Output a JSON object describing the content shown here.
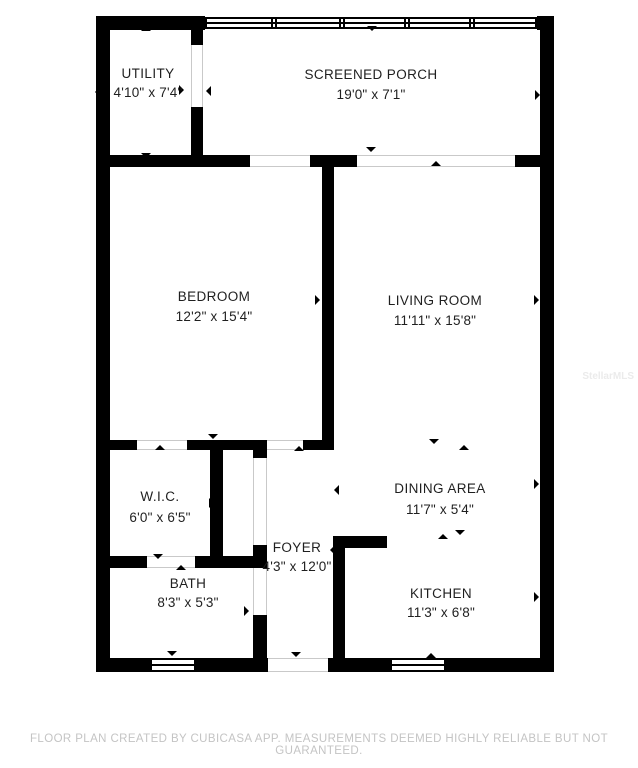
{
  "page": {
    "background": "#ffffff",
    "wall_color": "#000000",
    "opening_line_color": "#c9c9c9"
  },
  "watermark": {
    "text": "StellarMLS",
    "color": "#ebebeb"
  },
  "footer": {
    "text": "FLOOR PLAN CREATED BY CUBICASA APP. MEASUREMENTS DEEMED HIGHLY RELIABLE BUT NOT GUARANTEED.",
    "color": "#c4c4c4"
  },
  "floorplan": {
    "rooms": [
      {
        "id": "utility",
        "name": "UTILITY",
        "dims": "4'10\" x 7'4\"",
        "cx": 148,
        "name_y": 67,
        "dims_y": 86
      },
      {
        "id": "porch",
        "name": "SCREENED PORCH",
        "dims": "19'0\" x 7'1\"",
        "cx": 371,
        "name_y": 68,
        "dims_y": 88
      },
      {
        "id": "bedroom",
        "name": "BEDROOM",
        "dims": "12'2\" x 15'4\"",
        "cx": 214,
        "name_y": 290,
        "dims_y": 310
      },
      {
        "id": "living",
        "name": "LIVING ROOM",
        "dims": "11'11\" x 15'8\"",
        "cx": 435,
        "name_y": 294,
        "dims_y": 314
      },
      {
        "id": "wic",
        "name": "W.I.C.",
        "dims": "6'0\" x 6'5\"",
        "cx": 160,
        "name_y": 490,
        "dims_y": 511
      },
      {
        "id": "dining",
        "name": "DINING AREA",
        "dims": "11'7\" x 5'4\"",
        "cx": 440,
        "name_y": 482,
        "dims_y": 503
      },
      {
        "id": "foyer",
        "name": "FOYER",
        "dims": "4'3\" x 12'0\"",
        "cx": 297,
        "name_y": 541,
        "dims_y": 560
      },
      {
        "id": "bath",
        "name": "BATH",
        "dims": "8'3\" x 5'3\"",
        "cx": 188,
        "name_y": 577,
        "dims_y": 596
      },
      {
        "id": "kitchen",
        "name": "KITCHEN",
        "dims": "11'3\" x 6'8\"",
        "cx": 441,
        "name_y": 587,
        "dims_y": 606
      }
    ],
    "walls": [
      [
        96,
        16,
        14,
        656
      ],
      [
        96,
        16,
        109,
        14
      ],
      [
        537,
        16,
        17,
        14
      ],
      [
        540,
        16,
        14,
        656
      ],
      [
        96,
        658,
        54,
        14
      ],
      [
        196,
        658,
        72,
        14
      ],
      [
        328,
        658,
        62,
        14
      ],
      [
        446,
        658,
        108,
        14
      ],
      [
        191,
        16,
        12,
        29
      ],
      [
        191,
        107,
        12,
        60
      ],
      [
        96,
        155,
        154,
        12
      ],
      [
        310,
        155,
        47,
        12
      ],
      [
        515,
        155,
        39,
        12
      ],
      [
        322,
        160,
        12,
        290
      ],
      [
        303,
        440,
        19,
        10
      ],
      [
        96,
        440,
        41,
        10
      ],
      [
        187,
        440,
        80,
        10
      ],
      [
        253,
        440,
        14,
        18
      ],
      [
        210,
        448,
        13,
        110
      ],
      [
        96,
        556,
        51,
        12
      ],
      [
        195,
        556,
        63,
        12
      ],
      [
        253,
        545,
        14,
        23
      ],
      [
        253,
        615,
        14,
        57
      ],
      [
        333,
        536,
        54,
        12
      ],
      [
        333,
        536,
        12,
        136
      ]
    ],
    "windows": [
      {
        "x": 205,
        "y": 17,
        "w": 332,
        "h": 12,
        "mullions": [
          272,
          340,
          405,
          470
        ]
      },
      {
        "x": 150,
        "y": 658,
        "w": 46,
        "h": 14,
        "mullions": []
      },
      {
        "x": 390,
        "y": 658,
        "w": 56,
        "h": 14,
        "mullions": []
      }
    ],
    "openings": [
      {
        "x": 191,
        "y": 45,
        "w": 12,
        "h": 62,
        "dir": "v"
      },
      {
        "x": 250,
        "y": 155,
        "w": 60,
        "h": 12,
        "dir": "h"
      },
      {
        "x": 357,
        "y": 155,
        "w": 158,
        "h": 12,
        "dir": "h"
      },
      {
        "x": 137,
        "y": 440,
        "w": 50,
        "h": 10,
        "dir": "h"
      },
      {
        "x": 267,
        "y": 440,
        "w": 36,
        "h": 10,
        "dir": "h"
      },
      {
        "x": 253,
        "y": 458,
        "w": 14,
        "h": 87,
        "dir": "v"
      },
      {
        "x": 147,
        "y": 556,
        "w": 48,
        "h": 12,
        "dir": "h"
      },
      {
        "x": 253,
        "y": 568,
        "w": 14,
        "h": 47,
        "dir": "v"
      },
      {
        "x": 268,
        "y": 658,
        "w": 60,
        "h": 14,
        "dir": "h"
      }
    ],
    "arrows": [
      {
        "x": 146,
        "y": 31,
        "dir": "up"
      },
      {
        "x": 100,
        "y": 92,
        "dir": "left"
      },
      {
        "x": 184,
        "y": 90,
        "dir": "right"
      },
      {
        "x": 146,
        "y": 158,
        "dir": "down"
      },
      {
        "x": 372,
        "y": 31,
        "dir": "down"
      },
      {
        "x": 211,
        "y": 91,
        "dir": "left"
      },
      {
        "x": 540,
        "y": 95,
        "dir": "right"
      },
      {
        "x": 371,
        "y": 152,
        "dir": "down"
      },
      {
        "x": 214,
        "y": 166,
        "dir": "up"
      },
      {
        "x": 103,
        "y": 300,
        "dir": "left"
      },
      {
        "x": 320,
        "y": 300,
        "dir": "right"
      },
      {
        "x": 213,
        "y": 439,
        "dir": "down"
      },
      {
        "x": 436,
        "y": 166,
        "dir": "up"
      },
      {
        "x": 332,
        "y": 300,
        "dir": "left"
      },
      {
        "x": 539,
        "y": 300,
        "dir": "right"
      },
      {
        "x": 434,
        "y": 444,
        "dir": "down"
      },
      {
        "x": 464,
        "y": 450,
        "dir": "up"
      },
      {
        "x": 339,
        "y": 490,
        "dir": "left"
      },
      {
        "x": 539,
        "y": 484,
        "dir": "right"
      },
      {
        "x": 460,
        "y": 535,
        "dir": "down"
      },
      {
        "x": 443,
        "y": 539,
        "dir": "up"
      },
      {
        "x": 342,
        "y": 598,
        "dir": "left"
      },
      {
        "x": 539,
        "y": 597,
        "dir": "right"
      },
      {
        "x": 431,
        "y": 658,
        "dir": "up"
      },
      {
        "x": 160,
        "y": 450,
        "dir": "up"
      },
      {
        "x": 103,
        "y": 503,
        "dir": "left"
      },
      {
        "x": 214,
        "y": 503,
        "dir": "right"
      },
      {
        "x": 158,
        "y": 559,
        "dir": "down"
      },
      {
        "x": 181,
        "y": 570,
        "dir": "up"
      },
      {
        "x": 103,
        "y": 612,
        "dir": "left"
      },
      {
        "x": 249,
        "y": 611,
        "dir": "right"
      },
      {
        "x": 172,
        "y": 656,
        "dir": "down"
      },
      {
        "x": 299,
        "y": 451,
        "dir": "up"
      },
      {
        "x": 259,
        "y": 550,
        "dir": "right"
      },
      {
        "x": 335,
        "y": 550,
        "dir": "left"
      },
      {
        "x": 296,
        "y": 657,
        "dir": "down"
      }
    ]
  }
}
